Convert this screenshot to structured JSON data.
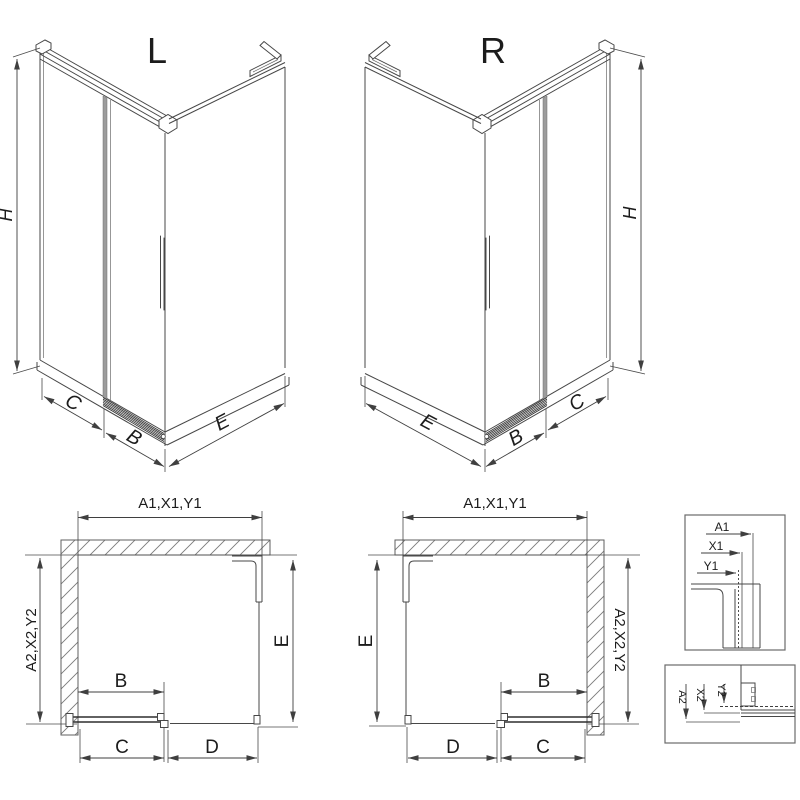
{
  "colors": {
    "line": "#474747",
    "dim_line": "#3f3f3f",
    "label": "#1c1c1c",
    "door_seal_gray": "#9c9c9c",
    "background": "#ffffff"
  },
  "iso_left": {
    "variant": "L",
    "dim_height": "H",
    "dim_c": "C",
    "dim_b": "B",
    "dim_e": "E"
  },
  "iso_right": {
    "variant": "R",
    "dim_height": "H",
    "dim_c": "C",
    "dim_b": "B",
    "dim_e": "E"
  },
  "plan_left": {
    "dim_width": "A1,X1,Y1",
    "dim_depth": "A2,X2,Y2",
    "dim_e": "E",
    "dim_b": "B",
    "dim_c": "C",
    "dim_d": "D"
  },
  "plan_right": {
    "dim_width": "A1,X1,Y1",
    "dim_depth": "A2,X2,Y2",
    "dim_e": "E",
    "dim_b": "B",
    "dim_c": "C",
    "dim_d": "D"
  },
  "detail_top": {
    "dim_a1": "A1",
    "dim_x1": "X1",
    "dim_y1": "Y1"
  },
  "detail_bottom": {
    "dim_a2": "A2",
    "dim_x2": "X2",
    "dim_y2": "Y2"
  }
}
